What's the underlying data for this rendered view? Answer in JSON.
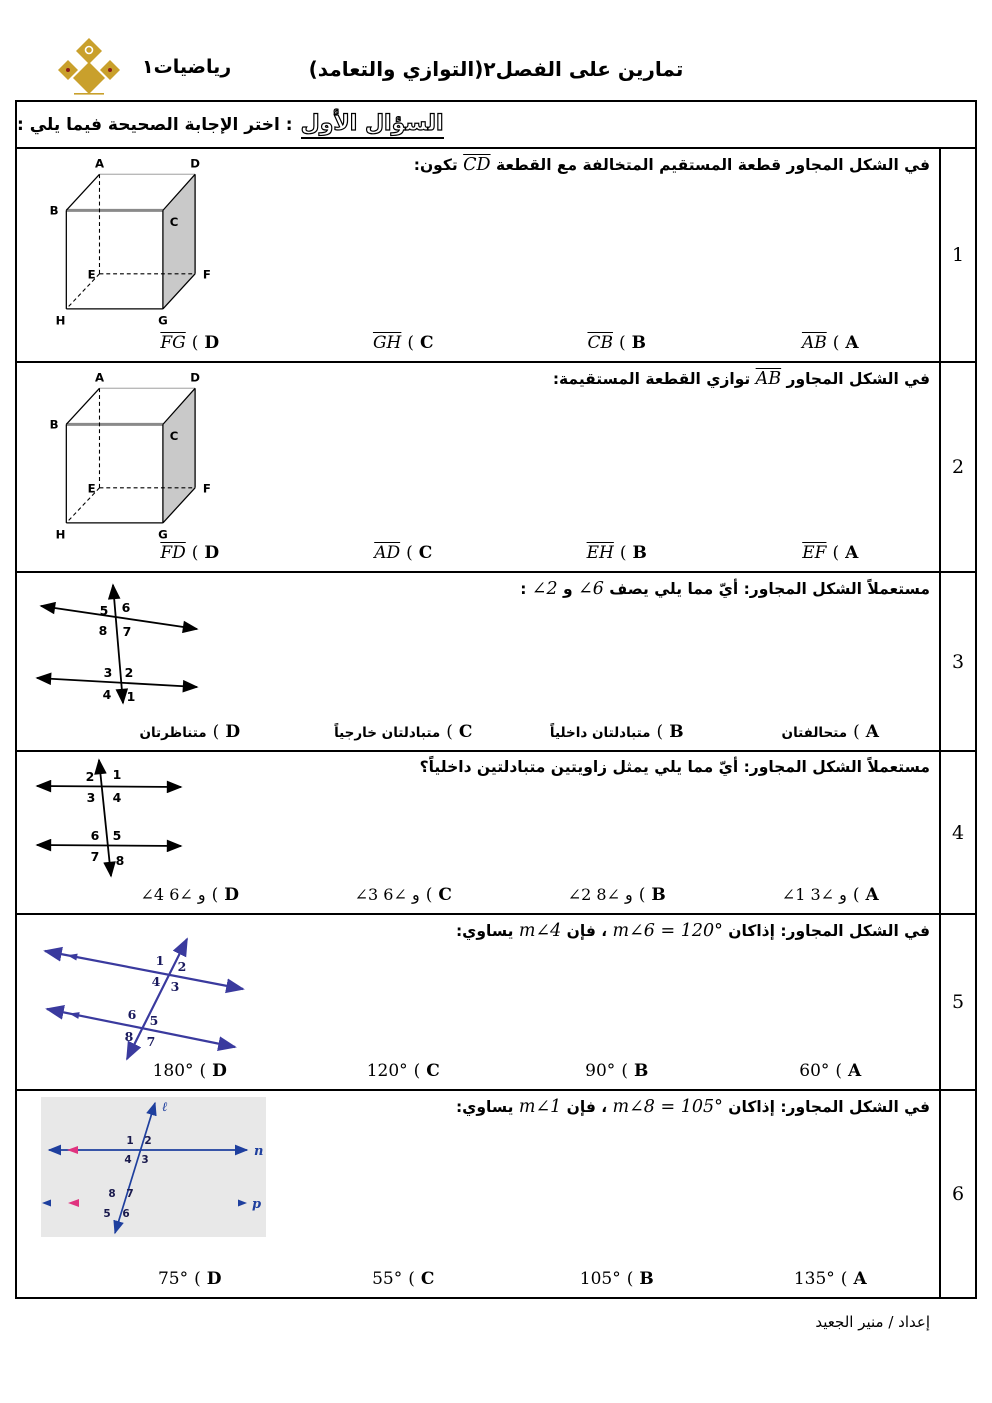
{
  "ui": {
    "open_paren": "("
  },
  "header": {
    "title": "تمارين على الفصل٢(التوازي والتعامد)",
    "logo_label": "رياضيات١"
  },
  "section": {
    "title": "السؤال الأول",
    "instruction": ": اختر الإجابة الصحيحة فيما يلي :"
  },
  "footer": {
    "prepared_by": "إعداد / منير الجعيد"
  },
  "questions": [
    {
      "number": "1",
      "text_pre": "في الشكل المجاور قطعة المستقيم المتخالفة مع القطعة",
      "math1": "CD",
      "text_post": "تكون:",
      "figure": {
        "type": "cube",
        "labels": {
          "a": "A",
          "b": "B",
          "c": "C",
          "d": "D",
          "e": "E",
          "f": "F",
          "g": "G",
          "h": "H"
        }
      },
      "options": [
        {
          "letter": "A",
          "value": "AB"
        },
        {
          "letter": "B",
          "value": "CB"
        },
        {
          "letter": "C",
          "value": "GH"
        },
        {
          "letter": "D",
          "value": "FG"
        }
      ]
    },
    {
      "number": "2",
      "text_pre": "في الشكل المجاور",
      "math1": "AB",
      "text_post": "توازي القطعة المستقيمة:",
      "figure": {
        "type": "cube",
        "labels": {
          "a": "A",
          "b": "B",
          "c": "C",
          "d": "D",
          "e": "E",
          "f": "F",
          "g": "G",
          "h": "H"
        }
      },
      "options": [
        {
          "letter": "A",
          "value": "EF"
        },
        {
          "letter": "B",
          "value": "EH"
        },
        {
          "letter": "C",
          "value": "AD"
        },
        {
          "letter": "D",
          "value": "FD"
        }
      ]
    },
    {
      "number": "3",
      "text_pre": "مستعملاً الشكل المجاور: أيّ مما يلي يصف",
      "math1": "∠6",
      "text_mid": "و",
      "math2": "∠2",
      "text_post": ":",
      "figure": {
        "type": "two-lines-transversal",
        "angles_top": [
          "5",
          "6",
          "8",
          "7"
        ],
        "angles_bottom": [
          "3",
          "2",
          "4",
          "1"
        ]
      },
      "options": [
        {
          "letter": "A",
          "value": "متحالفتان"
        },
        {
          "letter": "B",
          "value": "متبادلتان داخلياً"
        },
        {
          "letter": "C",
          "value": "متبادلتان خارجياً"
        },
        {
          "letter": "D",
          "value": "متناظرتان"
        }
      ]
    },
    {
      "number": "4",
      "text_pre": "مستعملاً الشكل المجاور: أيّ مما يلي يمثل زاويتين متبادلتين داخلياً؟",
      "figure": {
        "type": "two-lines-transversal",
        "angles_top": [
          "2",
          "1",
          "3",
          "4"
        ],
        "angles_bottom": [
          "6",
          "5",
          "7",
          "8"
        ]
      },
      "options": [
        {
          "letter": "A",
          "value": "∠1 و ∠3"
        },
        {
          "letter": "B",
          "value": "∠2 و ∠8"
        },
        {
          "letter": "C",
          "value": "∠3 و ∠6"
        },
        {
          "letter": "D",
          "value": "∠4 و ∠6"
        }
      ]
    },
    {
      "number": "5",
      "text_pre": "في الشكل المجاور: إذاكان",
      "math1": "m∠6 = 120°",
      "text_mid": "، فإن",
      "math2": "m∠4",
      "text_post": "يساوي:",
      "figure": {
        "type": "parallel-lines-transversal",
        "angles_top": [
          "1",
          "2",
          "4",
          "3"
        ],
        "angles_bottom": [
          "6",
          "5",
          "8",
          "7"
        ]
      },
      "options": [
        {
          "letter": "A",
          "value": "60°"
        },
        {
          "letter": "B",
          "value": "90°"
        },
        {
          "letter": "C",
          "value": "120°"
        },
        {
          "letter": "D",
          "value": "180°"
        }
      ]
    },
    {
      "number": "6",
      "text_pre": "في الشكل المجاور: إذاكان",
      "math1": "m∠8 = 105°",
      "text_mid": "، فإن",
      "math2": "m∠1",
      "text_post": "يساوي:",
      "figure": {
        "type": "lines-l-n-p",
        "line_labels": {
          "l": "ℓ",
          "n": "n",
          "p": "p"
        },
        "angles_top": [
          "1",
          "2",
          "4",
          "3"
        ],
        "angles_bottom": [
          "8",
          "7",
          "5",
          "6"
        ]
      },
      "options": [
        {
          "letter": "A",
          "value": "135°"
        },
        {
          "letter": "B",
          "value": "105°"
        },
        {
          "letter": "C",
          "value": "55°"
        },
        {
          "letter": "D",
          "value": "75°"
        }
      ]
    }
  ]
}
